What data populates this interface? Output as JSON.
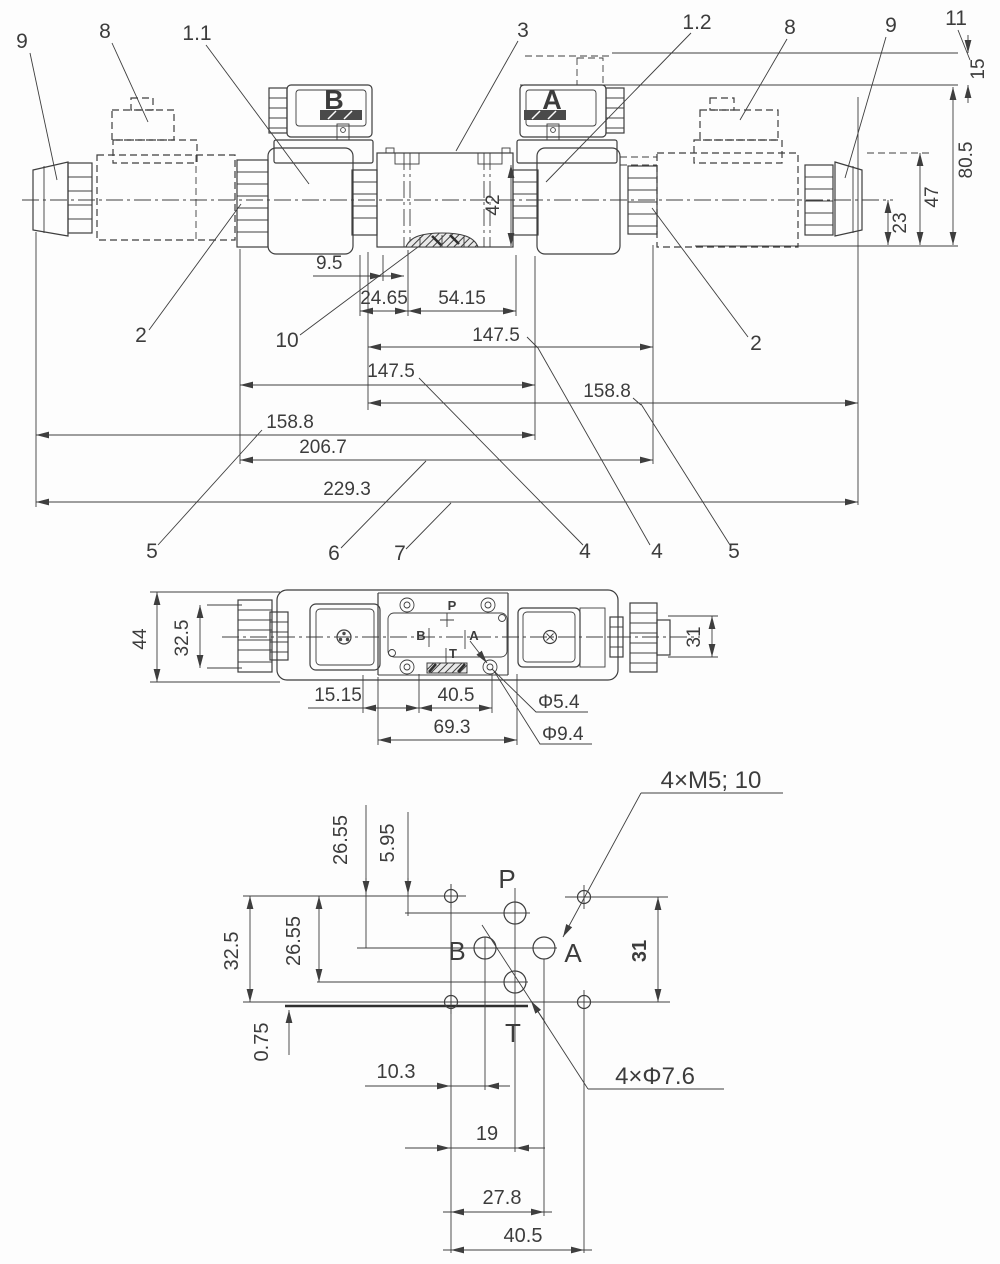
{
  "front_view": {
    "balloons": {
      "n9_left": "9",
      "n8_left": "8",
      "n1_1": "1.1",
      "n3": "3",
      "n1_2": "1.2",
      "n8_right": "8",
      "n9_right": "9",
      "n11": "11",
      "n2_left": "2",
      "n2_right": "2",
      "n10": "10",
      "n5_left": "5",
      "n6": "6",
      "n7": "7",
      "n4_left": "4",
      "n4_right": "4",
      "n5_right": "5"
    },
    "dims": {
      "d15": "15",
      "d80_5": "80.5",
      "d47": "47",
      "d23": "23",
      "d42": "42",
      "d9_5": "9.5",
      "d24_65": "24.65",
      "d54_15": "54.15",
      "d147_5_upper": "147.5",
      "d147_5_lower": "147.5",
      "d158_8_right": "158.8",
      "d158_8_left": "158.8",
      "d206_7": "206.7",
      "d229_3": "229.3"
    },
    "connectors": {
      "b": "B",
      "a": "A"
    }
  },
  "top_view": {
    "dims": {
      "d44": "44",
      "d32_5": "32.5",
      "d31": "31",
      "d15_15": "15.15",
      "d40_5": "40.5",
      "d69_3": "69.3",
      "phi5_4": "Φ5.4",
      "phi9_4": "Φ9.4"
    },
    "ports": {
      "p": "P",
      "b": "B",
      "a": "A",
      "t": "T"
    }
  },
  "bottom_view": {
    "callouts": {
      "m5": "4×M5; 10",
      "phi7_6": "4×Φ7.6"
    },
    "dims": {
      "d26_55_upper": "26.55",
      "d5_95": "5.95",
      "d32_5": "32.5",
      "d26_55_inner": "26.55",
      "d31": "31",
      "d0_75": "0.75",
      "d10_3": "10.3",
      "d19": "19",
      "d27_8": "27.8",
      "d40_5": "40.5"
    },
    "ports": {
      "p": "P",
      "b": "B",
      "a": "A",
      "t": "T"
    }
  }
}
